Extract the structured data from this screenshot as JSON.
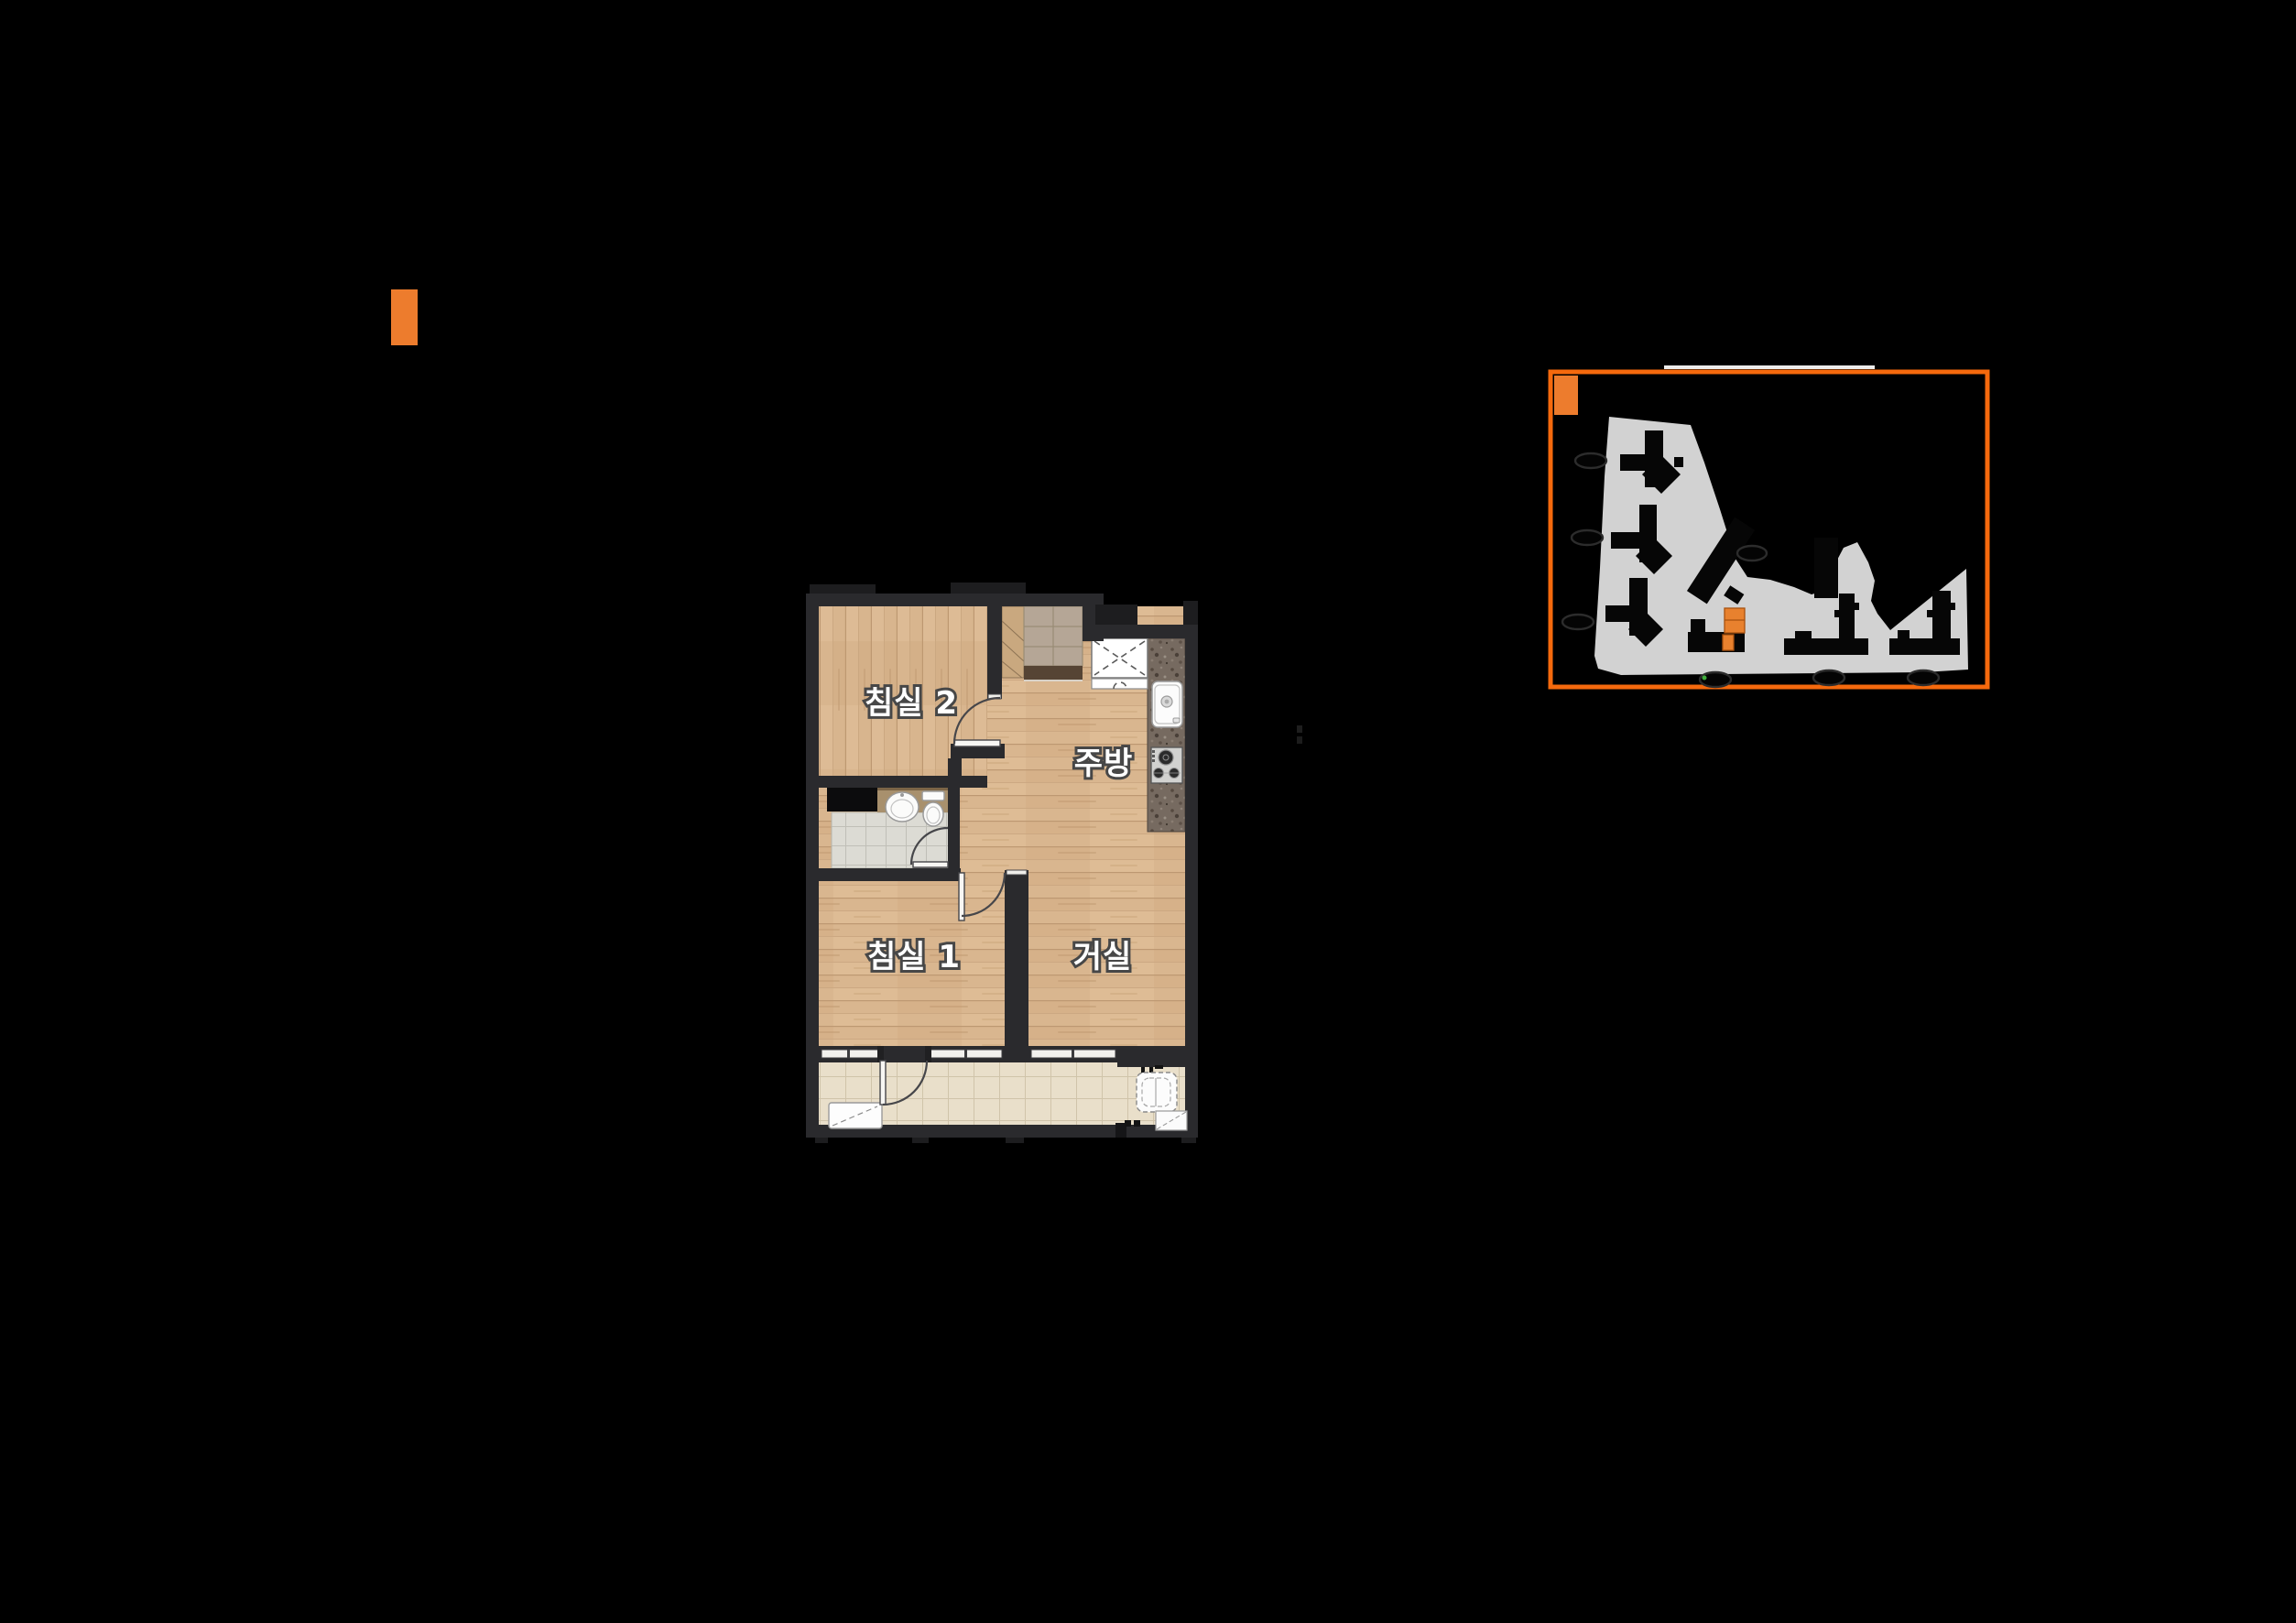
{
  "page": {
    "background": "#000000"
  },
  "top_marker": {
    "color": "#ed7c2d"
  },
  "floor_plan": {
    "labels": {
      "bedroom2": "침실 2",
      "kitchen": "주방",
      "bedroom1": "침실 1",
      "living": "거실"
    },
    "colors": {
      "wall": "#2a2a2d",
      "wood": "#d9b68f",
      "wood_seam": "#b7916a",
      "entry_tile": "#b5a696",
      "threshold_marble": "#564434",
      "bath_tile": "#dcdbd4",
      "bath_counter": "#a8906d",
      "balcony_tile": "#e9dfca",
      "counter_granite": "#766a60",
      "fixture_white": "#fbfbfa",
      "door_arc": "#46464a"
    }
  },
  "site_plan": {
    "border_color": "#f5690d",
    "legend_color": "#ed7c2d",
    "site_color": "#d2d2d2",
    "building_color": "#060606",
    "highlight_color": "#e8812e",
    "highlight_outline": "#a9520f",
    "oval_outline": "#2c2c2c",
    "green_dot": "#3fae3c",
    "white_tick": "#ececec",
    "label_oval_count": 7
  }
}
